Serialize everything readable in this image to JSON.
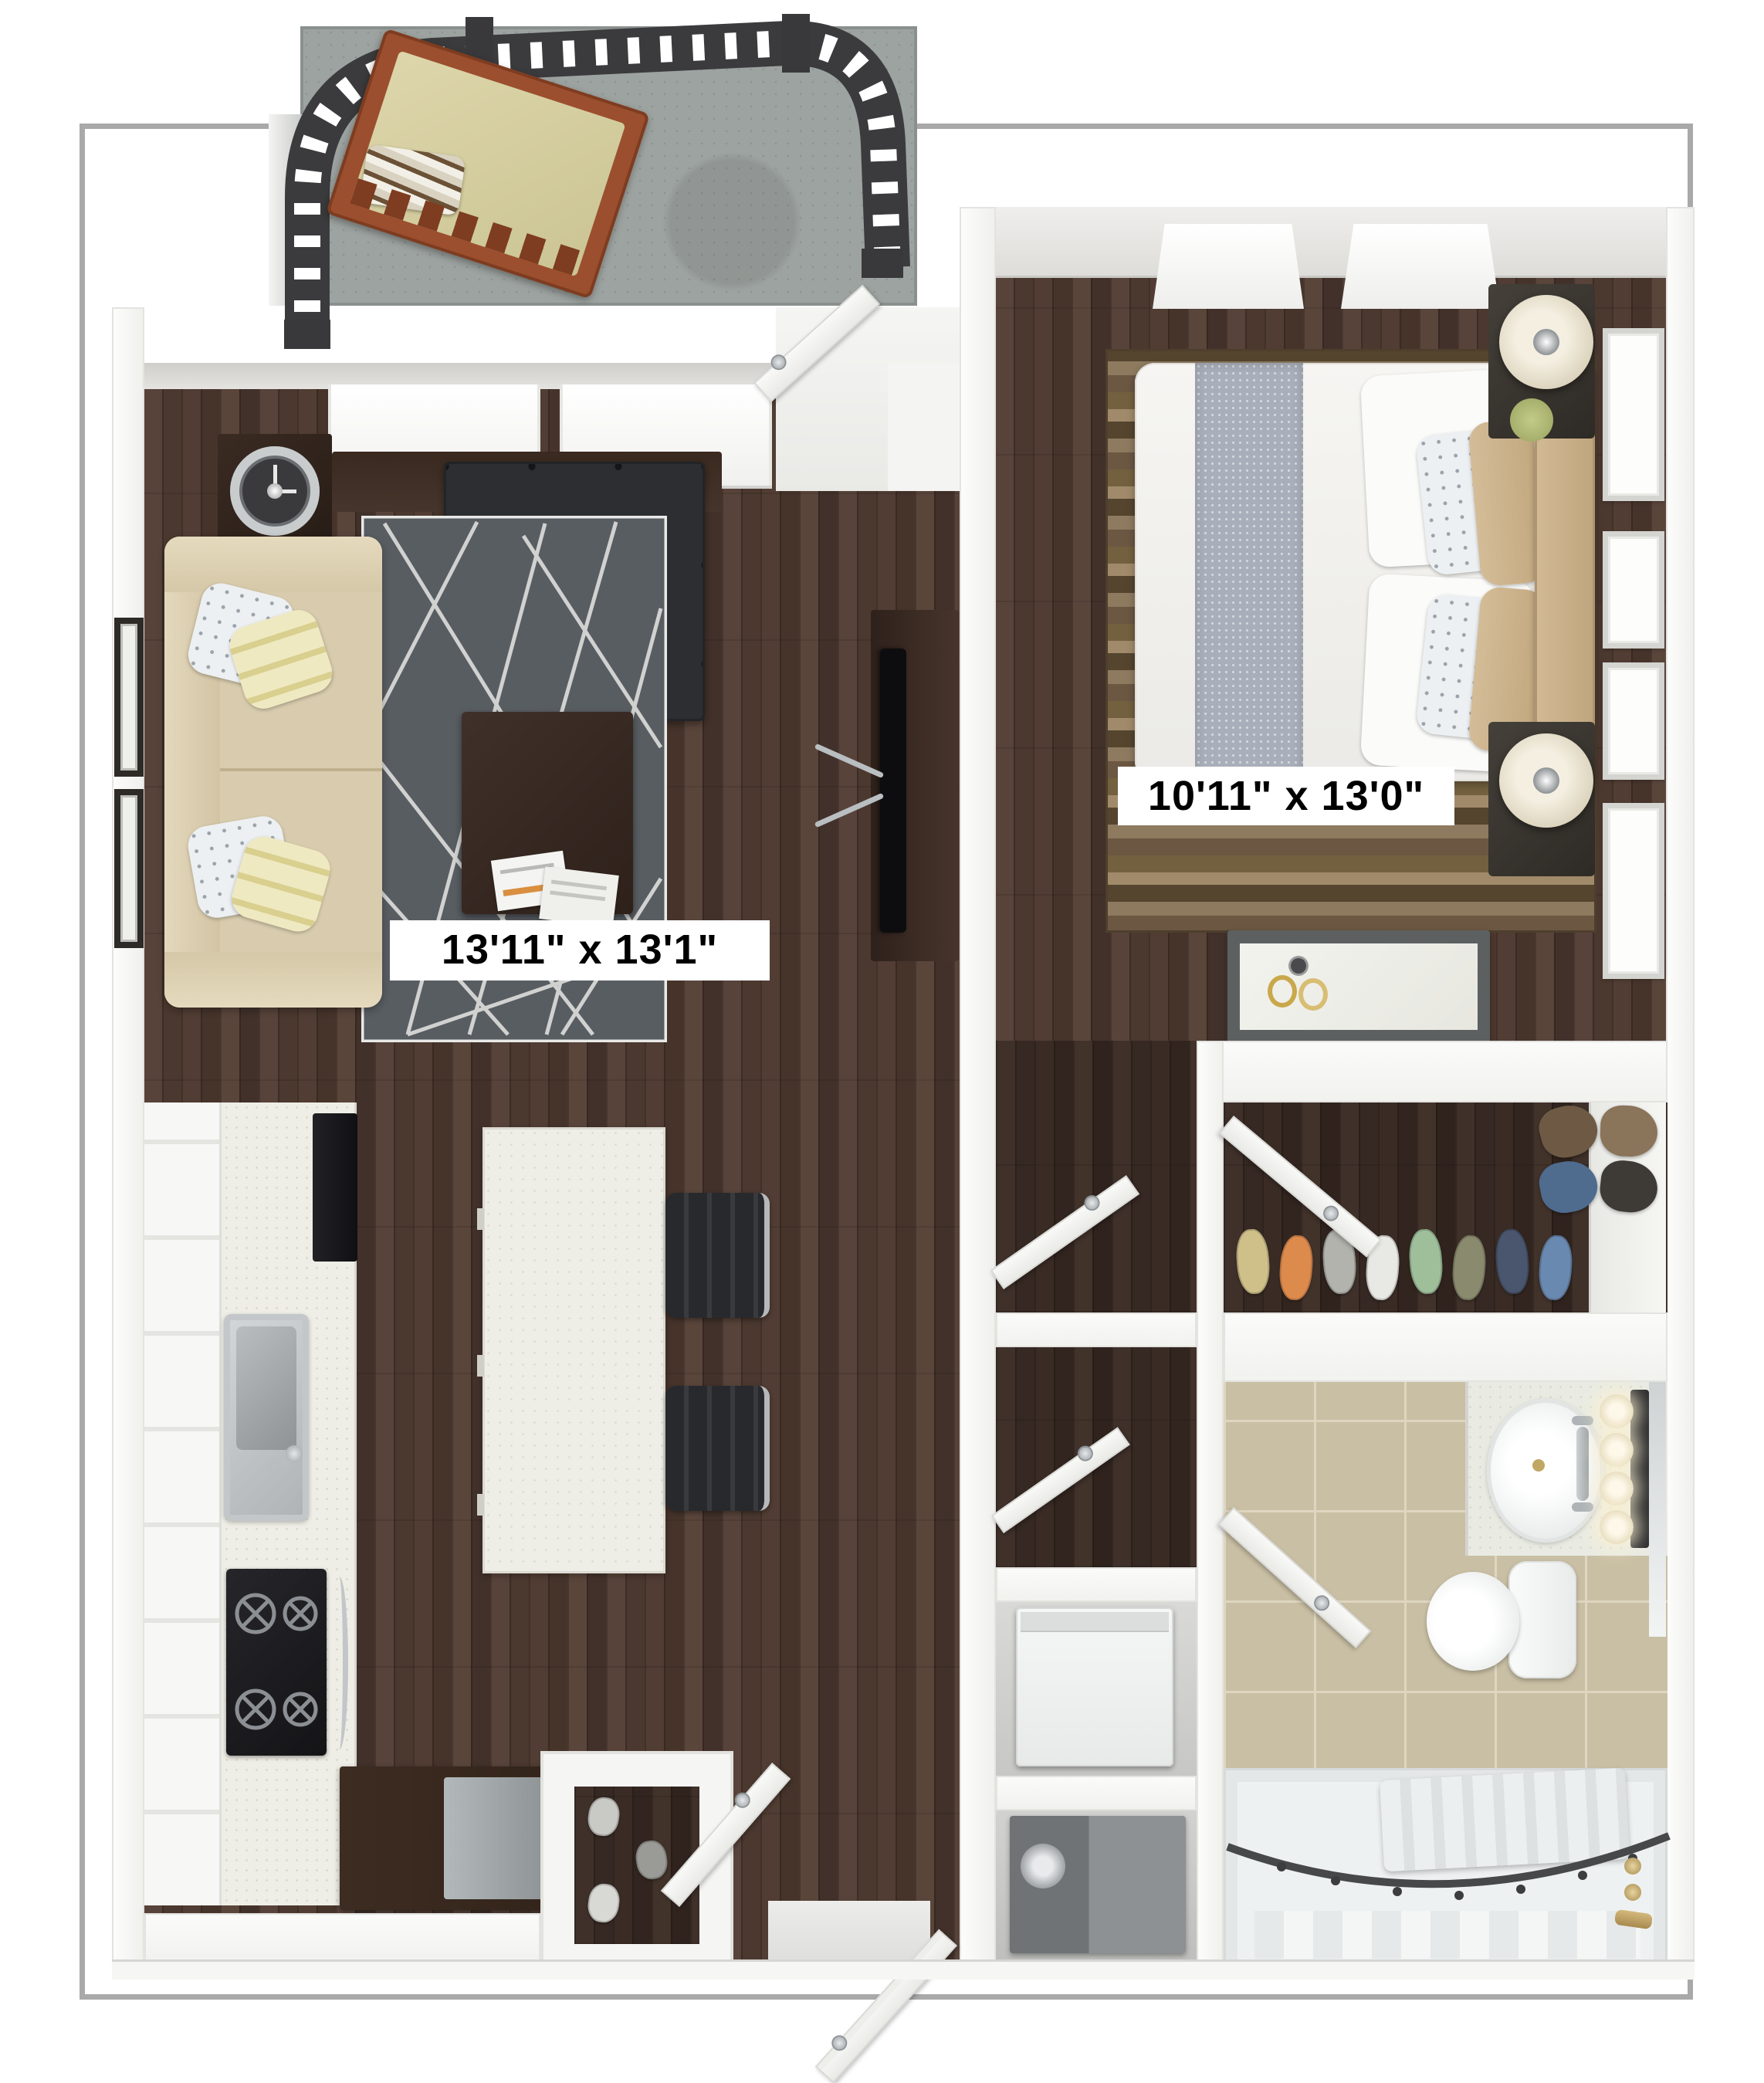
{
  "plan": {
    "type": "apartment-floor-plan-3d",
    "labels": {
      "living_room": "13'11\" x 13'1\"",
      "bedroom": "10'11\" x 13'0\""
    },
    "palette": {
      "page_bg": "#ffffff",
      "plan_border": "#a9a9a9",
      "wood_floor": "#4c392f",
      "wall_white": "#f7f7f5",
      "wall_shadow": "#d7d6d3",
      "balcony_concrete": "#9da3a0",
      "railing_iron": "#3b3b3d",
      "living_rug": "#585d62",
      "sofa_beige": "#d9ccae",
      "ottoman_black": "#2c2e31",
      "kitchen_island": "#efeee6",
      "stool_black": "#28292c",
      "bath_tile": "#c9bfa4",
      "tub_white": "#eef1f1",
      "brass_fixture": "#b89a5e",
      "headboard_tan": "#c9b18c",
      "bench_wood": "#9b4f2e",
      "bench_cushion": "#d6cfa2"
    },
    "walk_in_closet": {
      "shoes": [
        "#cfc08a",
        "#dd8a4d",
        "#b3b3ae",
        "#e8e8e4",
        "#9ebf9a",
        "#8a8a6e",
        "#4a566e",
        "#6a89b0"
      ],
      "garments": [
        "#6e5a44",
        "#8a745a",
        "#4f6b8e",
        "#3e3a36"
      ]
    },
    "entry_closet": {
      "shoes": [
        "#c9c9c6",
        "#9a9a96",
        "#d8d8d4"
      ]
    },
    "bathroom": {
      "vanity_bulbs": [
        1,
        2,
        3,
        4
      ]
    }
  }
}
